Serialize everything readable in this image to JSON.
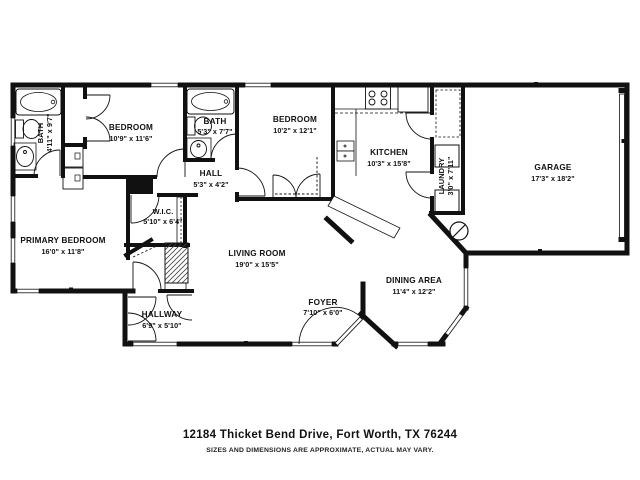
{
  "rooms": [
    {
      "id": "bath-1",
      "name": "BATH",
      "dims": "4'11\" x 9'7\""
    },
    {
      "id": "bedroom-1",
      "name": "BEDROOM",
      "dims": "10'9\" x 11'6\""
    },
    {
      "id": "bath-2",
      "name": "BATH",
      "dims": "5'3\" x 7'7\""
    },
    {
      "id": "hall",
      "name": "HALL",
      "dims": "5'3\" x 4'2\""
    },
    {
      "id": "bedroom-2",
      "name": "BEDROOM",
      "dims": "10'2\" x 12'1\""
    },
    {
      "id": "kitchen",
      "name": "KITCHEN",
      "dims": "10'3\" x 15'8\""
    },
    {
      "id": "laundry",
      "name": "LAUNDRY",
      "dims": "3'0\" x 7'11\""
    },
    {
      "id": "garage",
      "name": "GARAGE",
      "dims": "17'3\" x 18'2\""
    },
    {
      "id": "wic",
      "name": "W.I.C.",
      "dims": "5'10\" x 6'4\""
    },
    {
      "id": "primary-bedroom",
      "name": "PRIMARY BEDROOM",
      "dims": "16'0\" x 11'8\""
    },
    {
      "id": "living-room",
      "name": "LIVING ROOM",
      "dims": "19'0\" x 15'5\""
    },
    {
      "id": "dining-area",
      "name": "DINING AREA",
      "dims": "11'4\" x 12'2\""
    },
    {
      "id": "foyer",
      "name": "FOYER",
      "dims": "7'10\" x 6'0\""
    },
    {
      "id": "hallway",
      "name": "HALLWAY",
      "dims": "6'9\" x 5'10\""
    }
  ],
  "footer": {
    "address": "12184 Thicket Bend Drive, Fort Worth, TX 76244",
    "disclaimer": "SIZES AND DIMENSIONS ARE APPROXIMATE, ACTUAL MAY VARY."
  },
  "colors": {
    "wall": "#111111",
    "background": "#ffffff",
    "hatch": "#444444"
  }
}
